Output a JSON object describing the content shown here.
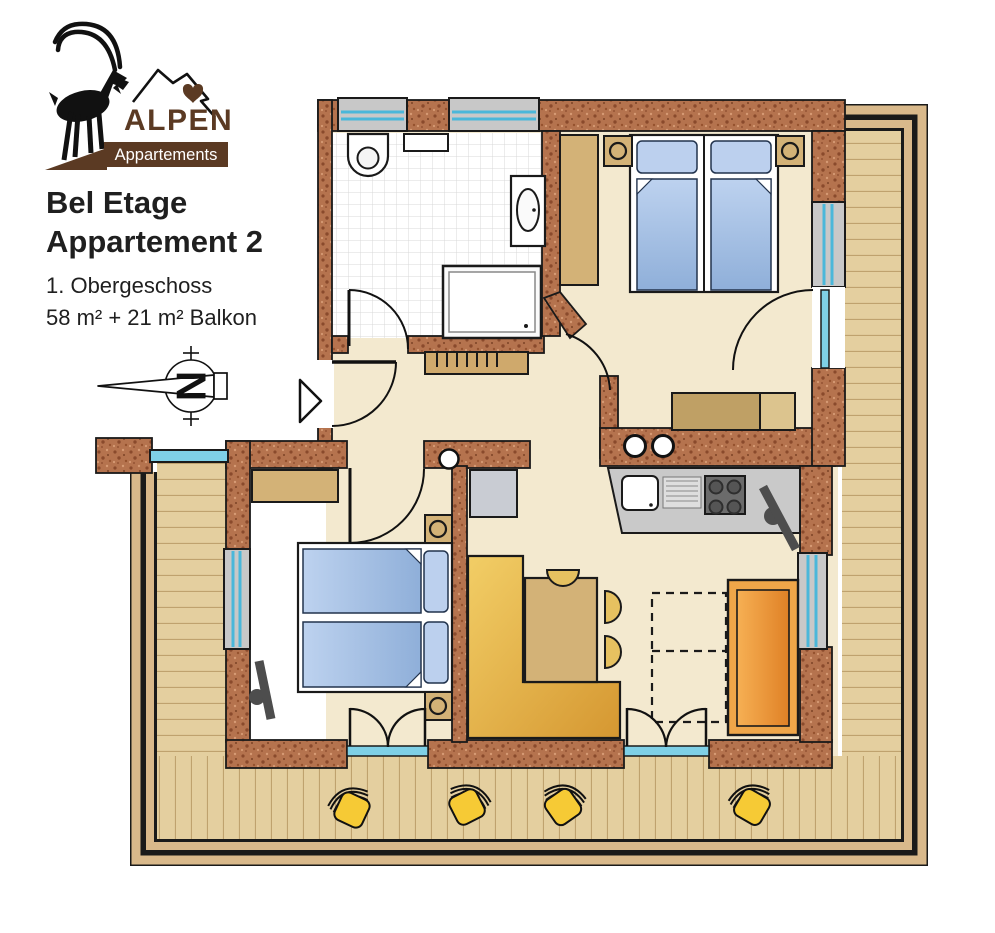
{
  "logo": {
    "brand": "ALPEN",
    "subtitle": "Appartements"
  },
  "title": {
    "line1": "Bel Etage",
    "line2": "Appartement 2"
  },
  "details": {
    "floor": "1. Obergeschoss",
    "area": "58 m² + 21 m² Balkon"
  },
  "compass": {
    "letter": "N"
  },
  "colors": {
    "logo_brown": "#5b3a23",
    "wall_brick": "#b5734e",
    "floor_cream": "#f3e9cf",
    "balcony_wood": "#e4cf9f",
    "railing_tan": "#d9b98b",
    "window_glass": "#7fd0e6",
    "window_frame_blue": "#4ab7da",
    "bed_blue": "#a9c4e4",
    "furniture_tan": "#d3b277",
    "bench_gold": "#e8c050",
    "sofa_orange": "#efa649",
    "deckchair_yellow": "#f6ca35",
    "counter_gray": "#c9c9c9"
  }
}
